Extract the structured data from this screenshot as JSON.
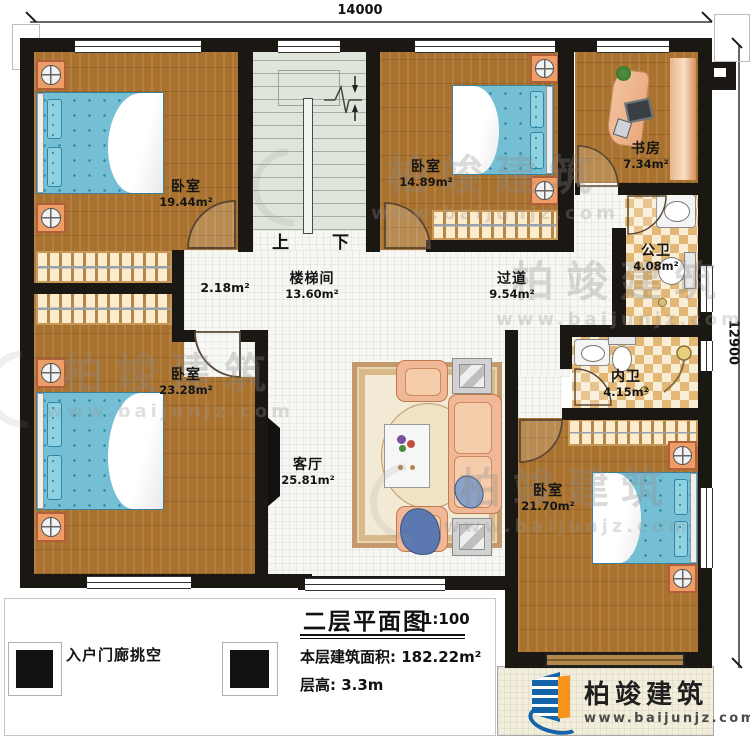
{
  "dims": {
    "width": "14000",
    "height": "12900"
  },
  "stairs": {
    "up": "上",
    "down": "下"
  },
  "rooms": {
    "bedroom_tl": {
      "name": "卧室",
      "area": "19.44m²"
    },
    "bedroom_tm": {
      "name": "卧室",
      "area": "14.89m²"
    },
    "study": {
      "name": "书房",
      "area": "7.34m²"
    },
    "bath_public": {
      "name": "公卫",
      "area": "4.08m²"
    },
    "bath_private": {
      "name": "内卫",
      "area": "4.15m²"
    },
    "bedroom_bl": {
      "name": "卧室",
      "area": "23.28m²"
    },
    "bedroom_br": {
      "name": "卧室",
      "area": "21.70m²"
    },
    "stairwell": {
      "name": "楼梯间",
      "area": "13.60m²"
    },
    "hallway": {
      "name": "过道",
      "area": "9.54m²"
    },
    "living": {
      "name": "客厅",
      "area": "25.81m²"
    },
    "nook": {
      "area": "2.18m²"
    }
  },
  "annotations": {
    "porch": "入户门廊挑空"
  },
  "title_block": {
    "title": "二层平面图",
    "scale": "1:100",
    "floor_area_label": "本层建筑面积:",
    "floor_area_value": "182.22m²",
    "floor_height_label": "层高:",
    "floor_height_value": "3.3m"
  },
  "brand": {
    "name": "柏竣建筑",
    "website": "www.baijunjz.com"
  },
  "colors": {
    "wall": "#1b1713",
    "wood_floor": "#a9722e",
    "bed_blue": "#74bfd4",
    "tile_tan": "#e3b877",
    "stair_green": "#dfe5da",
    "brand_blue": "#1563a8",
    "brand_orange": "#f7941d"
  }
}
